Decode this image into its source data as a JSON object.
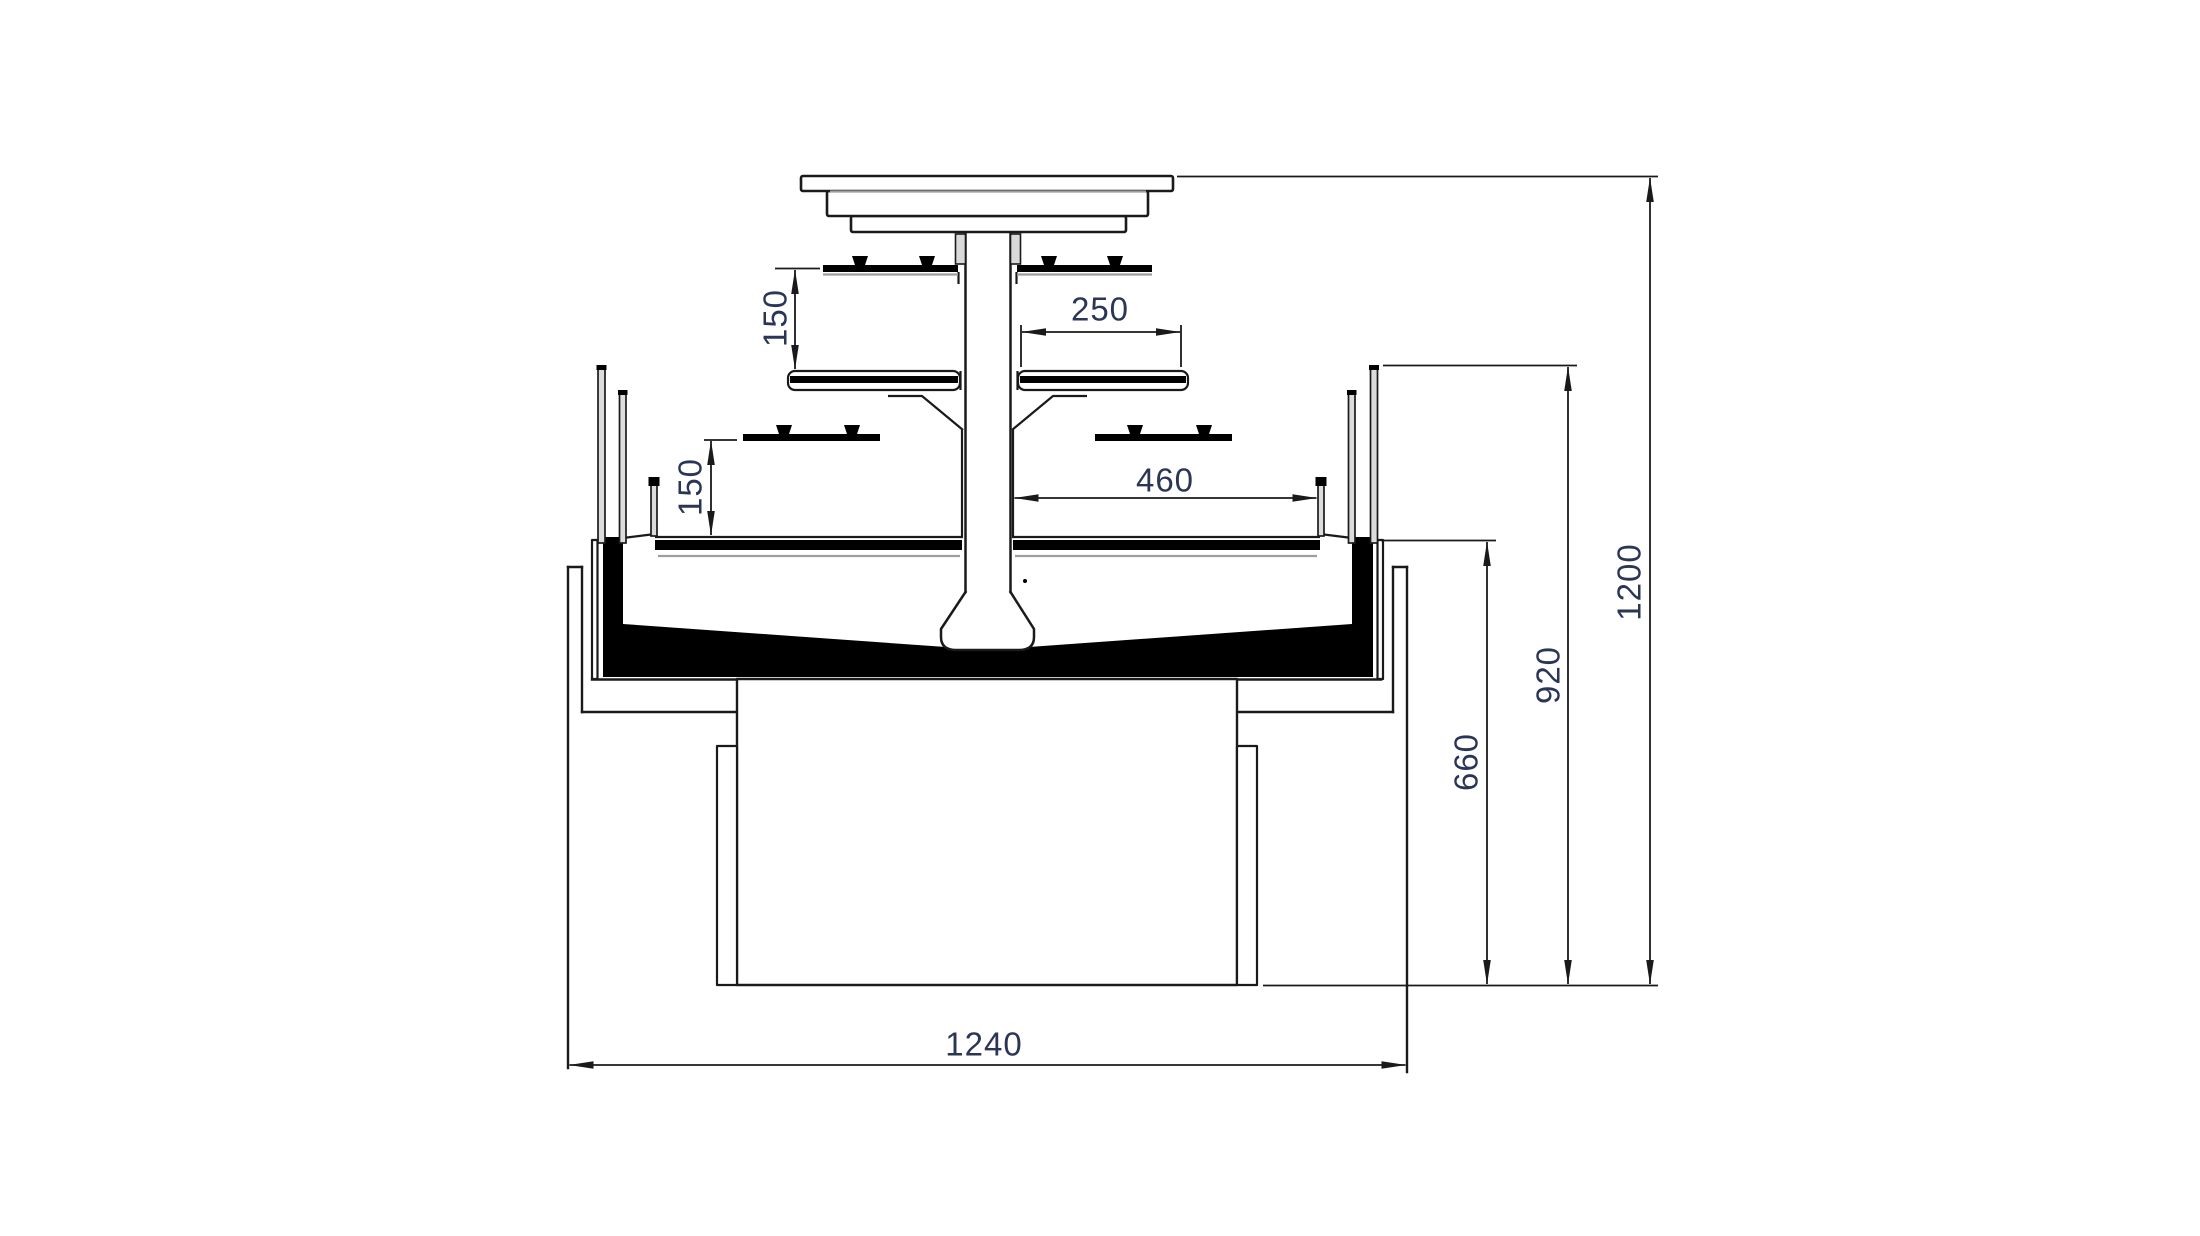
{
  "page": {
    "title": "Display case cross-section technical drawing",
    "background": "#ffffff"
  },
  "drawing": {
    "type": "technical-cross-section",
    "units": "mm",
    "colors": {
      "line": "#1a1a1a",
      "black_fill": "#000000",
      "gray_line": "#9e9e9e",
      "glass_fill": "#dcdcdc",
      "bracket_fill": "#d9d9d9",
      "dim_line": "#1a1a1a",
      "dim_text": "#2b3657",
      "background": "#ffffff"
    },
    "dimensions": [
      {
        "id": "upper-shelf-gap",
        "value": "150",
        "orientation": "vertical"
      },
      {
        "id": "upper-shelf-depth",
        "value": "250",
        "orientation": "horizontal"
      },
      {
        "id": "lower-shelf-gap",
        "value": "150",
        "orientation": "vertical"
      },
      {
        "id": "base-deck-depth",
        "value": "460",
        "orientation": "horizontal"
      },
      {
        "id": "overall-width",
        "value": "1240",
        "orientation": "horizontal"
      },
      {
        "id": "deck-floor-height",
        "value": "660",
        "orientation": "vertical"
      },
      {
        "id": "side-glass-height",
        "value": "920",
        "orientation": "vertical"
      },
      {
        "id": "overall-height",
        "value": "1200",
        "orientation": "vertical"
      }
    ]
  }
}
